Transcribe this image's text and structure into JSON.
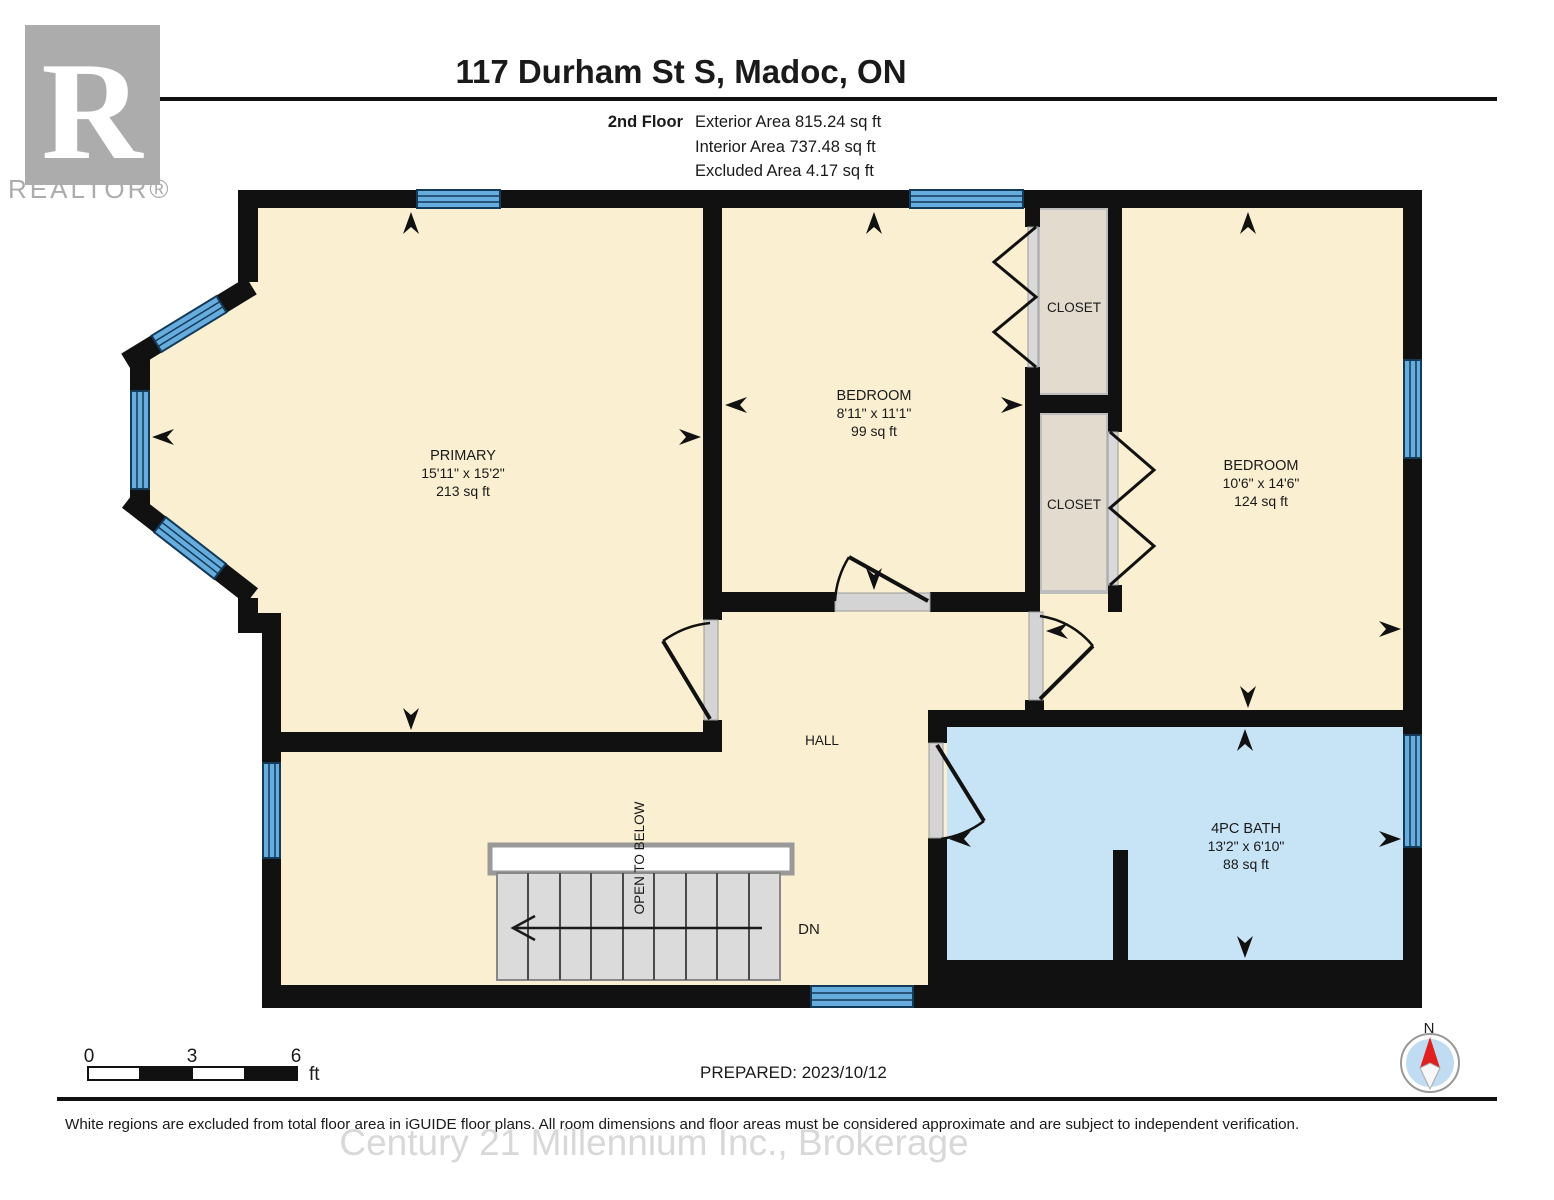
{
  "header": {
    "title": "117 Durham St S, Madoc, ON",
    "floor_label": "2nd Floor",
    "areas": [
      "Exterior Area 815.24 sq ft",
      "Interior Area 737.48 sq ft",
      "Excluded Area 4.17 sq ft"
    ]
  },
  "logo": {
    "letter": "R",
    "realtor": "REALTOR®"
  },
  "rooms": [
    {
      "id": "primary",
      "name": "PRIMARY",
      "dims": "15'11\" x 15'2\"",
      "area": "213 sq ft"
    },
    {
      "id": "bedroom-1",
      "name": "BEDROOM",
      "dims": "8'11\" x 11'1\"",
      "area": "99 sq ft"
    },
    {
      "id": "bedroom-2",
      "name": "BEDROOM",
      "dims": "10'6\" x 14'6\"",
      "area": "124 sq ft"
    },
    {
      "id": "bath",
      "name": "4PC BATH",
      "dims": "13'2\" x 6'10\"",
      "area": "88 sq ft"
    },
    {
      "id": "closet-1",
      "name": "CLOSET"
    },
    {
      "id": "closet-2",
      "name": "CLOSET"
    },
    {
      "id": "hall",
      "name": "HALL"
    }
  ],
  "stairs": {
    "open_label": "OPEN TO BELOW",
    "dn": "DN"
  },
  "scale": {
    "t0": "0",
    "t3": "3",
    "t6": "6",
    "unit": "ft"
  },
  "prepared": {
    "text": "PREPARED: 2023/10/12"
  },
  "compass": {
    "n": "N"
  },
  "footer": {
    "disclaimer": "White regions are excluded from total floor area in iGUIDE floor plans. All room dimensions and floor areas must be considered approximate and are subject to independent verification.",
    "watermark": "Century 21 Millennium Inc., Brokerage"
  },
  "colors": {
    "floor_cream": "#FAEFD0",
    "bath_blue": "#C7E3F6",
    "closet_tan": "#E3DBCE",
    "window_blue": "#66ACDC",
    "window_line": "#143A5A",
    "wall_black": "#111111",
    "stair_gray": "#DBDBDB",
    "compass_red": "#E02020",
    "logo_gray": "#ACACAC"
  }
}
